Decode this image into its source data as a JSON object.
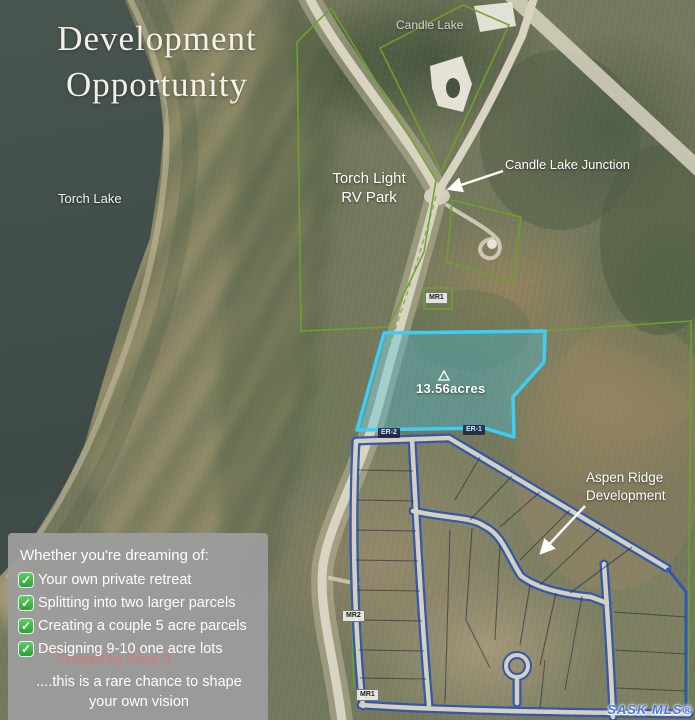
{
  "title": {
    "line1": "Development",
    "line2": "Opportunity"
  },
  "labels": {
    "candle_lake": "Candle Lake",
    "junction": "Candle Lake Junction",
    "rv_park_1": "Torch Light",
    "rv_park_2": "RV Park",
    "torch_lake": "Torch Lake",
    "acreage": "13.56acres",
    "aspen_1": "Aspen Ridge",
    "aspen_2": "Development",
    "chip_mr1_upper": "MR1",
    "chip_er2": "ER-2",
    "chip_er1": "ER-1",
    "chip_mr2": "MR2",
    "chip_mr1_lower": "MR1"
  },
  "infobox": {
    "heading": "Whether you're dreaming of:",
    "items": [
      "Your own private retreat",
      "Splitting into two larger parcels",
      "Creating a couple 5 acre parcels",
      "Designing 9-10 one acre lots"
    ],
    "footer_1": "....this is a rare chance to shape",
    "footer_2": "your own vision"
  },
  "watermarks": {
    "creator": "Created by Paint S",
    "mls": "SASK MLS®"
  },
  "colors": {
    "parcel_cyan": "#3ecdf4",
    "parcel_green": "#6ba32d",
    "development_blue": "#2e57b2",
    "infobox_gray": "#9c9c9c",
    "check_green": "#3fb54a",
    "lake_water": "#3d4a46"
  }
}
